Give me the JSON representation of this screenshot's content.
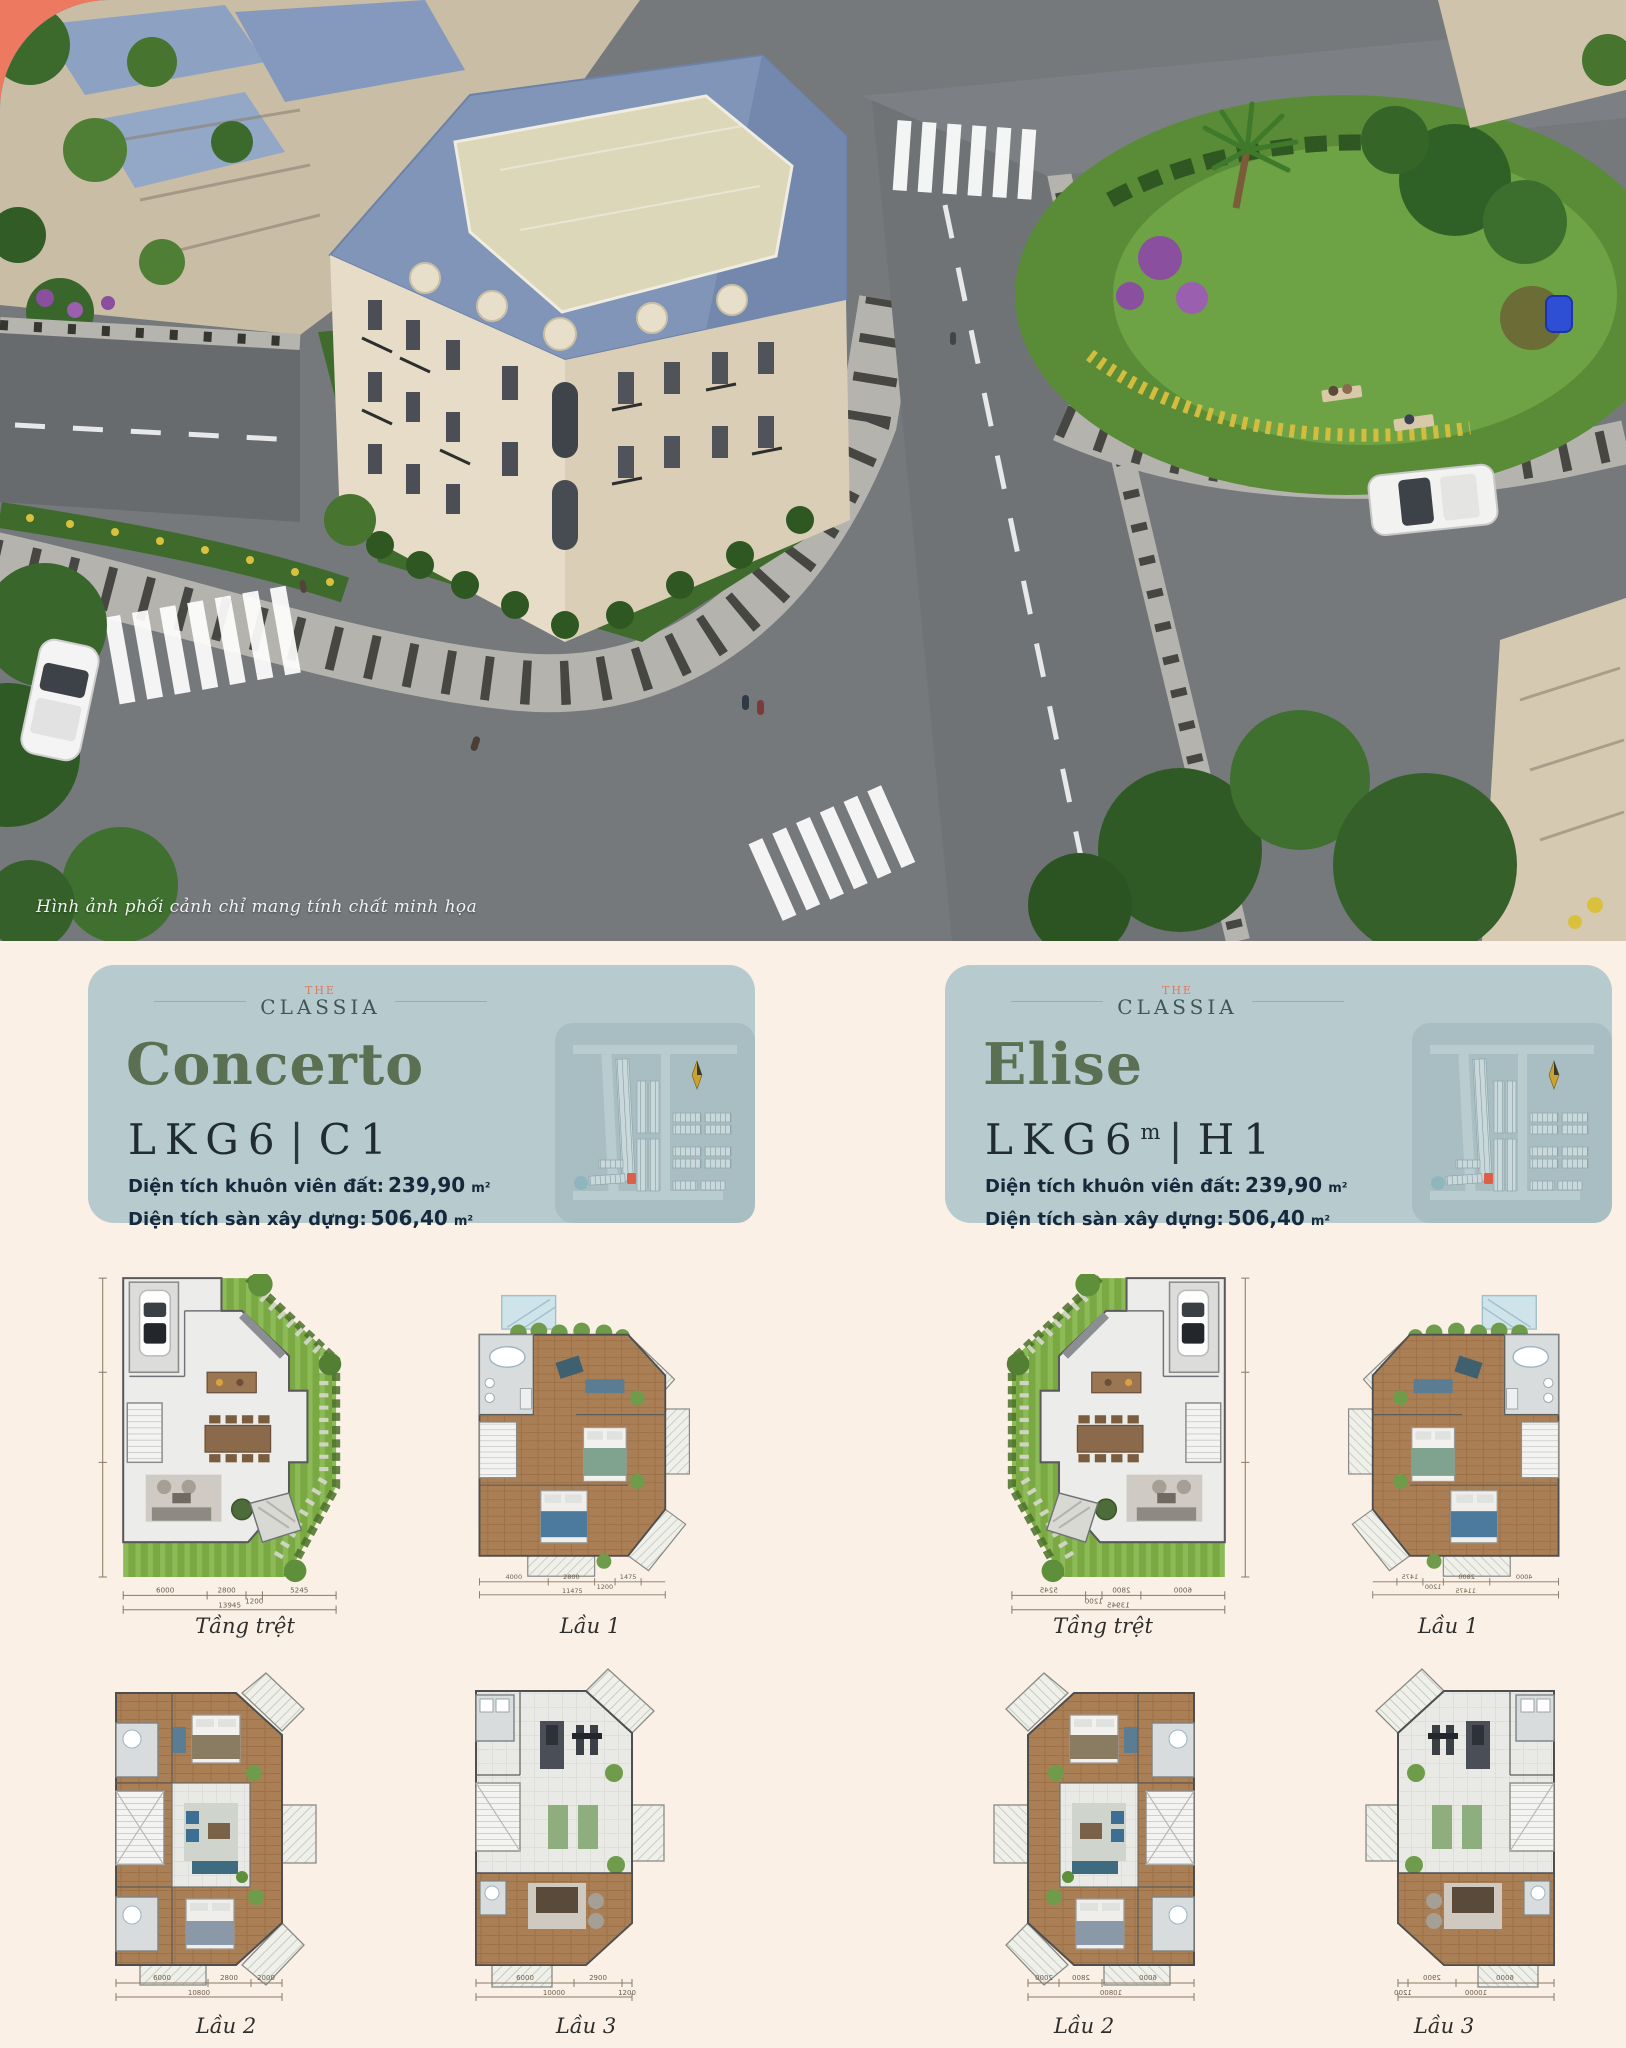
{
  "page": {
    "background": "#fbf0e6",
    "accent_corner_color": "#ee7961",
    "card_background": "#b7cbcf",
    "title_green": "#5b7052",
    "logo_coral": "#e0785f",
    "highlight_lot_red": "#dd5f47"
  },
  "hero": {
    "caption": "Hình ảnh phối cảnh chỉ mang tính chất minh họa"
  },
  "brand": {
    "the": "THE",
    "classia": "CLASSIA"
  },
  "cards": [
    {
      "title": "Concerto",
      "code": "LKG6",
      "code_sup": "",
      "divider": "|",
      "unit_code": "C1",
      "specs": [
        {
          "label": "Diện tích khuôn viên đất:",
          "value": "239,90",
          "unit": "m²"
        },
        {
          "label": "Diện tích sàn xây dựng:",
          "value": "506,40",
          "unit": "m²"
        }
      ]
    },
    {
      "title": "Elise",
      "code": "LKG6",
      "code_sup": "m",
      "divider": "|",
      "unit_code": "H1",
      "specs": [
        {
          "label": "Diện tích khuôn viên đất:",
          "value": "239,90",
          "unit": "m²"
        },
        {
          "label": "Diện tích sàn xây dựng:",
          "value": "506,40",
          "unit": "m²"
        }
      ]
    }
  ],
  "plans": [
    {
      "name": "Tầng trệt",
      "dims": [
        "6000",
        "2800",
        "1200",
        "5245"
      ],
      "total": "13945"
    },
    {
      "name": "Lầu 1",
      "dims": [
        "4000",
        "2800",
        "1200",
        "1475"
      ],
      "total": "11475"
    },
    {
      "name": "Lầu 2",
      "dims": [
        "6000",
        "2800",
        "2000"
      ],
      "total": "10800"
    },
    {
      "name": "Lầu 3",
      "dims": [
        "6000",
        "2900",
        "1200"
      ],
      "total": "10000"
    }
  ]
}
